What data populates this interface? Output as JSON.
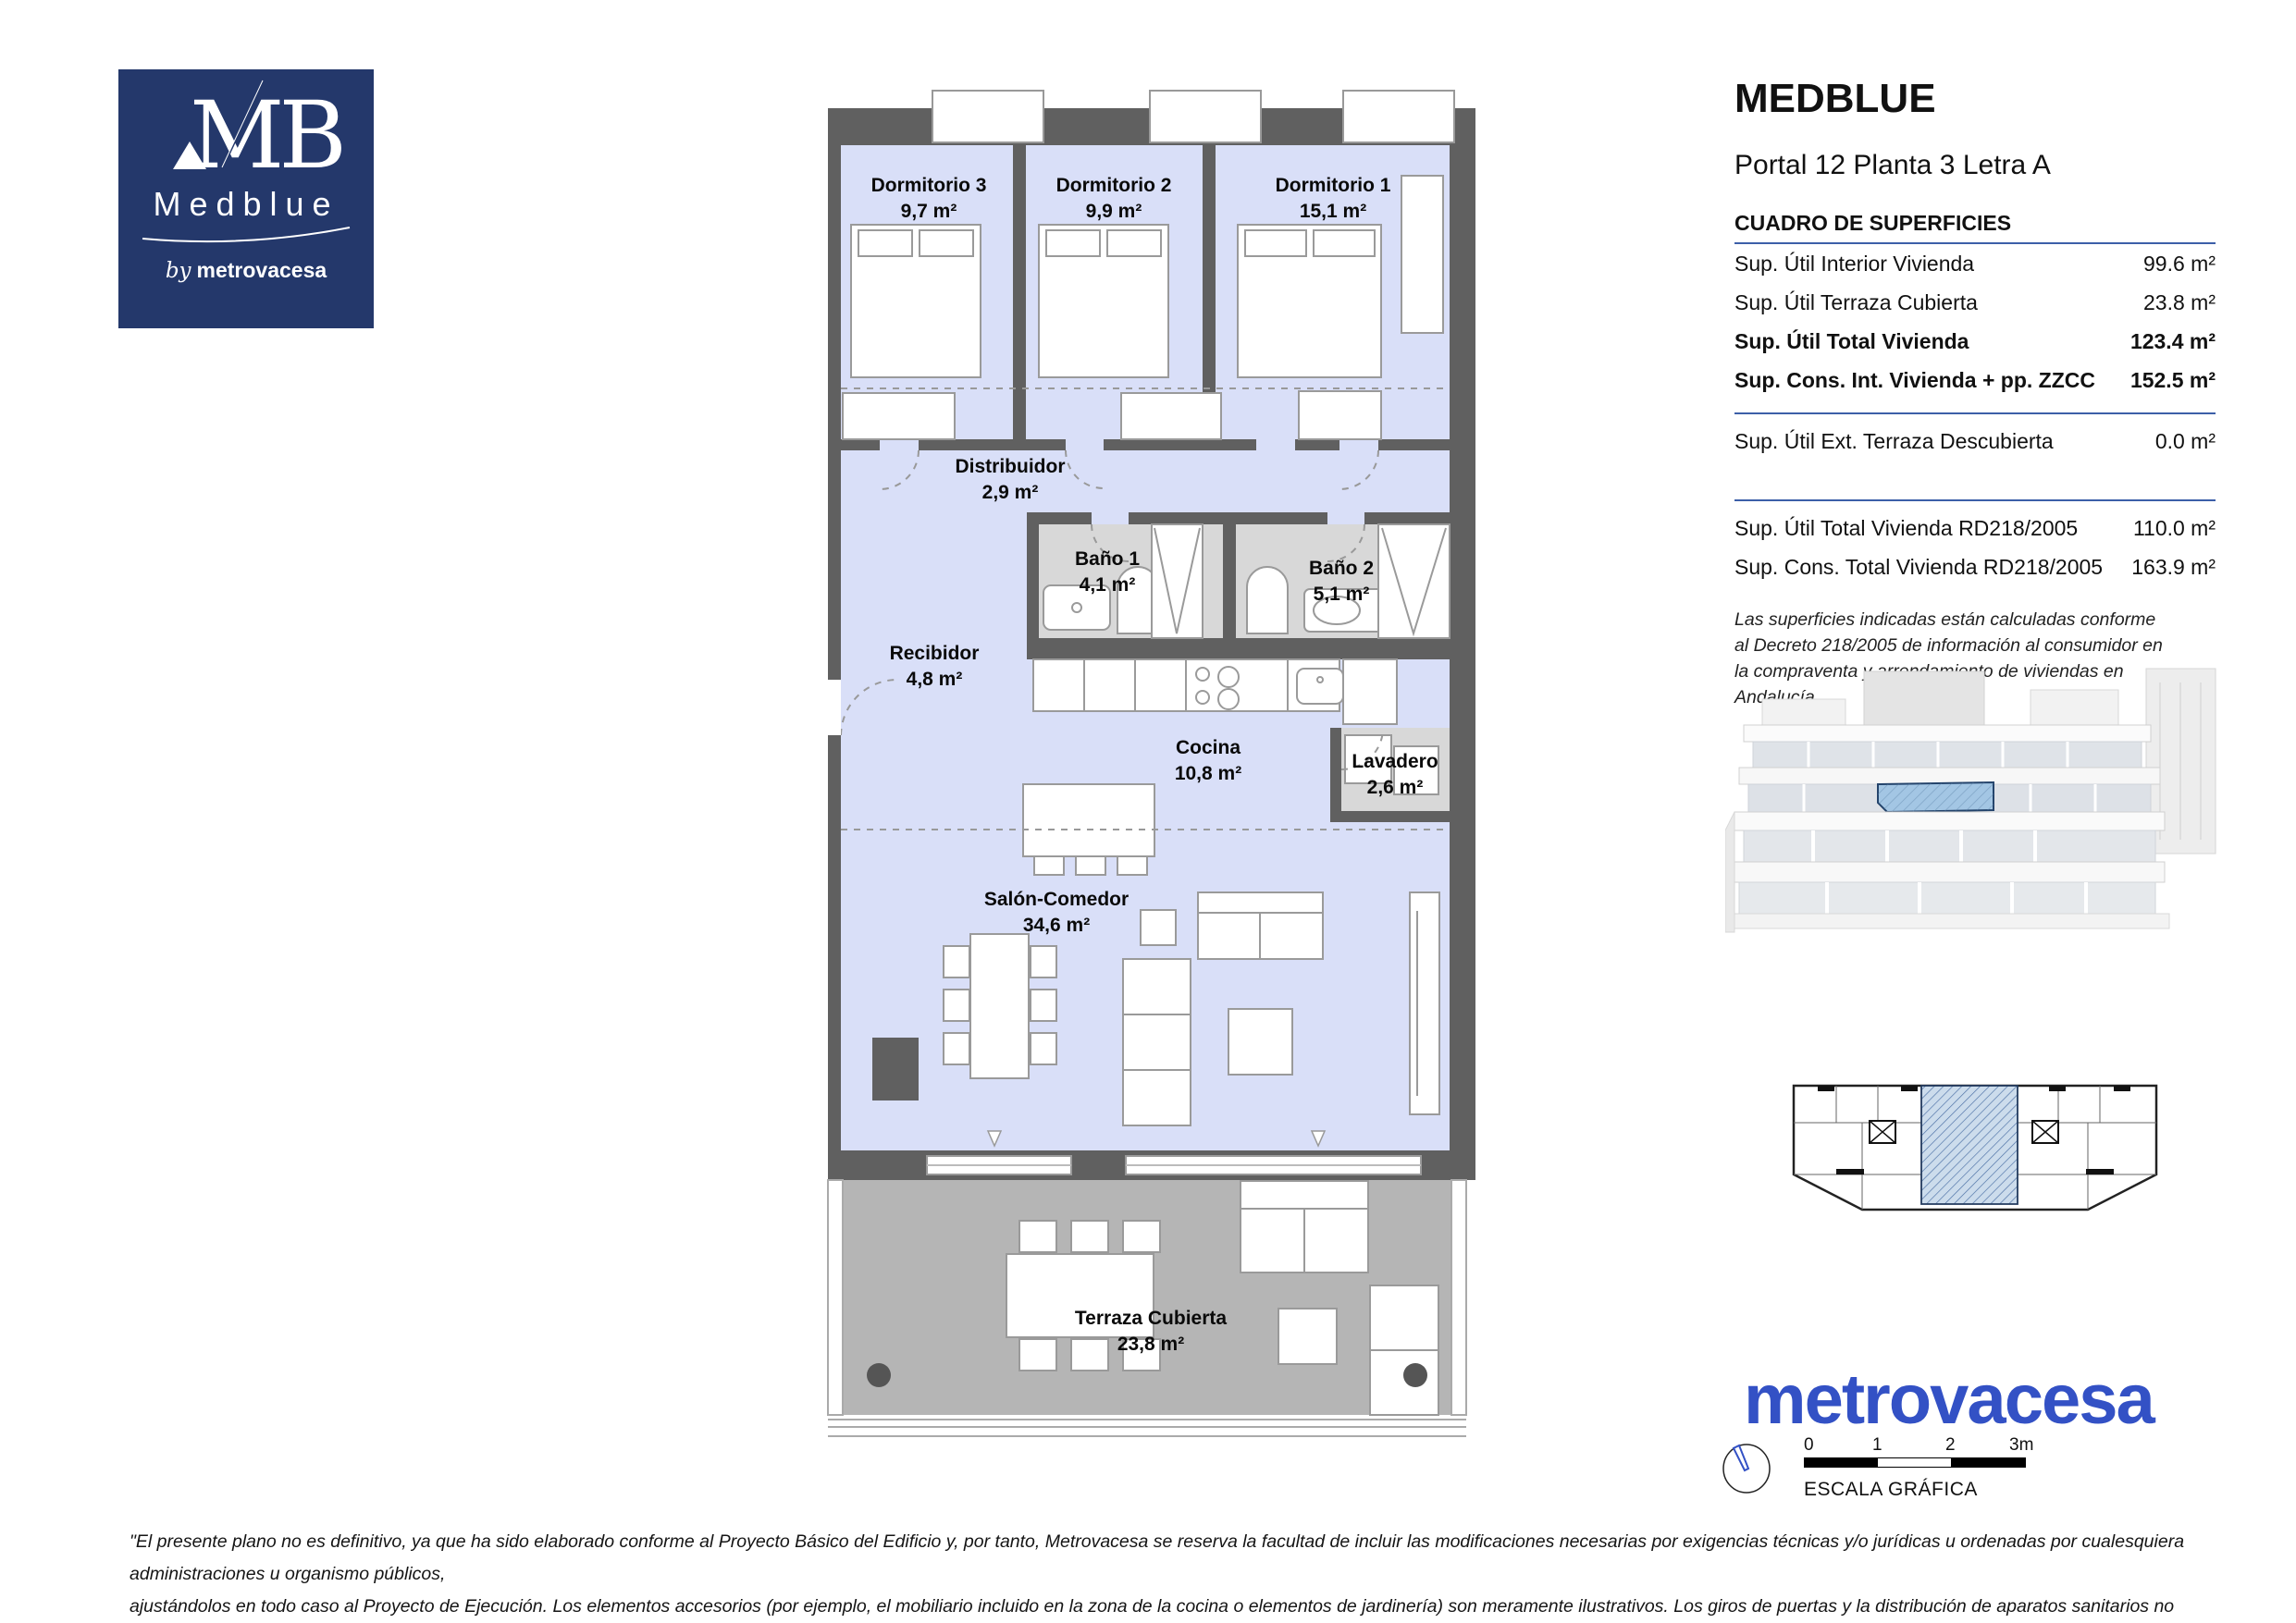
{
  "logo": {
    "monogram": "MB",
    "brand": "Medblue",
    "by": "by",
    "company": "metrovacesa"
  },
  "header": {
    "title": "MEDBLUE",
    "subtitle": "Portal 12 Planta 3 Letra A"
  },
  "surfaces": {
    "heading": "CUADRO DE SUPERFICIES",
    "rows": [
      {
        "label": "Sup. Útil Interior Vivienda",
        "value": "99.6 m²"
      },
      {
        "label": "Sup. Útil Terraza Cubierta",
        "value": "23.8 m²"
      },
      {
        "label": "Sup. Útil Total Vivienda",
        "value": "123.4 m²"
      },
      {
        "label": "Sup. Cons. Int. Vivienda + pp. ZZCC",
        "value": "152.5 m²"
      }
    ],
    "ext_row": {
      "label": "Sup. Útil Ext. Terraza Descubierta",
      "value": "0.0 m²"
    },
    "rd_rows": [
      {
        "label": "Sup. Útil Total Vivienda RD218/2005",
        "value": "110.0 m²"
      },
      {
        "label": "Sup. Cons. Total Vivienda RD218/2005",
        "value": "163.9 m²"
      }
    ],
    "note": "Las superficies indicadas están calculadas conforme al Decreto 218/2005 de información al consumidor en la compraventa y arrendamiento de viviendas en Andalucía."
  },
  "plan": {
    "rooms": [
      {
        "name": "Dormitorio 3",
        "area": "9,7 m²"
      },
      {
        "name": "Dormitorio 2",
        "area": "9,9 m²"
      },
      {
        "name": "Dormitorio 1",
        "area": "15,1 m²"
      },
      {
        "name": "Distribuidor",
        "area": "2,9 m²"
      },
      {
        "name": "Baño 1",
        "area": "4,1 m²"
      },
      {
        "name": "Baño 2",
        "area": "5,1 m²"
      },
      {
        "name": "Recibidor",
        "area": "4,8 m²"
      },
      {
        "name": "Cocina",
        "area": "10,8 m²"
      },
      {
        "name": "Lavadero",
        "area": "2,6 m²"
      },
      {
        "name": "Salón-Comedor",
        "area": "34,6 m²"
      },
      {
        "name": "Terraza Cubierta",
        "area": "23,8 m²"
      }
    ]
  },
  "brandmark": "metrovacesa",
  "scale": {
    "ticks": [
      "0",
      "1",
      "2",
      "3m"
    ],
    "label": "ESCALA GRÁFICA"
  },
  "footer": {
    "lines": [
      "\"El presente plano no es definitivo, ya que ha sido elaborado conforme al Proyecto Básico del Edificio y, por tanto, Metrovacesa se reserva la facultad de incluir las modificaciones necesarias por exigencias técnicas y/o jurídicas u ordenadas por cualesquiera administraciones u organismo públicos,",
      "ajustándolos en todo caso al Proyecto de Ejecución. Los elementos accesorios (por ejemplo, el mobiliario incluido en la zona de la cocina o elementos de jardinería) son meramente ilustrativos. Los giros de puertas y la distribución de aparatos sanitarios no son vinculantes. Las superficies expresadas son",
      "aproximadas, pudiendo experimentar modificaciones por razones de índole técnico y/o legal en el desarrollo de la ejecución de las obras.\""
    ]
  },
  "colors": {
    "brand_navy": "#24386b",
    "metrovacesa_blue": "#3351c5",
    "plan_floor": "#d9dff8",
    "wall_gray": "#606060",
    "bath_gray": "#d8d8d8",
    "terrace_gray": "#b5b5b5",
    "unit_highlight": "#a3c6e4",
    "rule_blue": "#3c5fa8"
  }
}
